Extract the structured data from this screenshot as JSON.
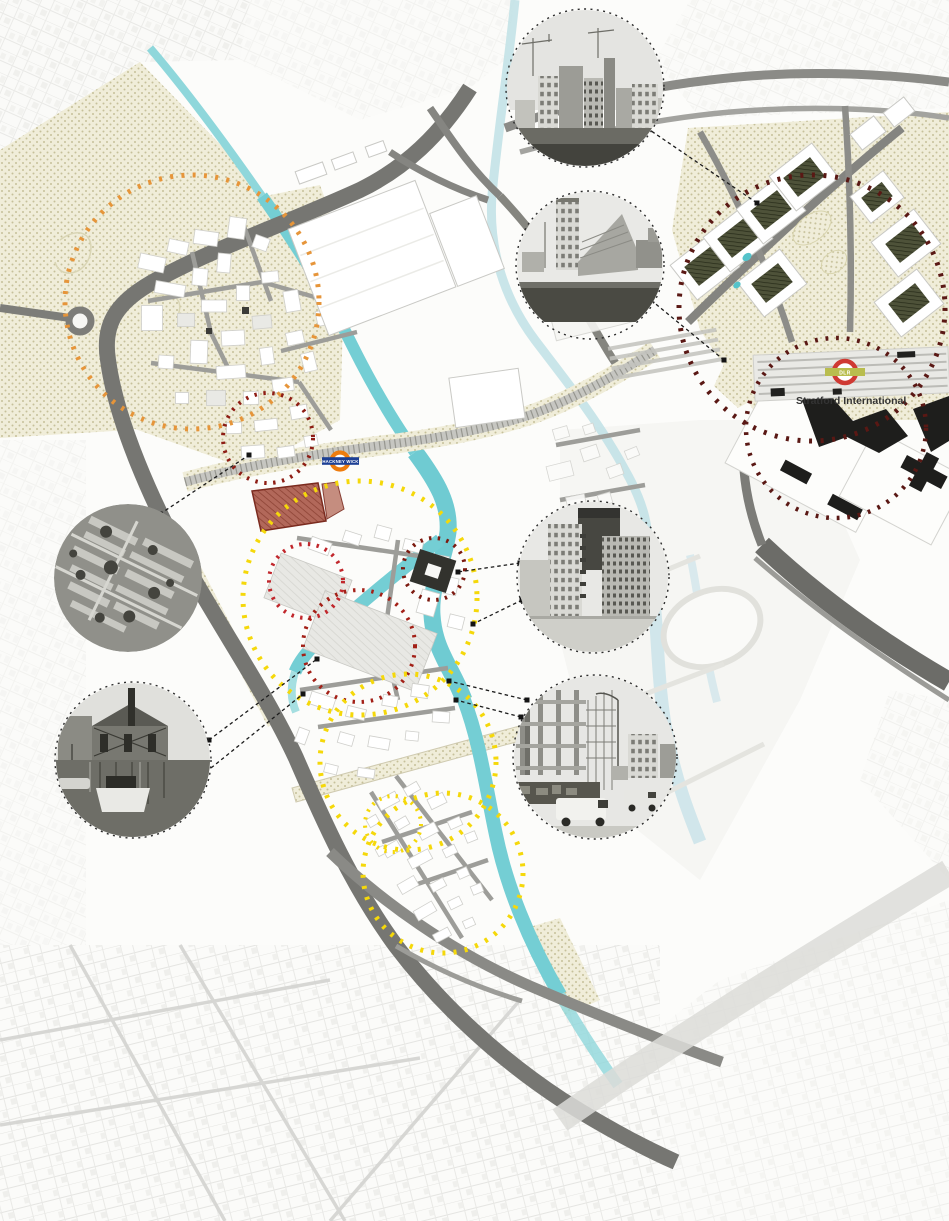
{
  "map": {
    "description": "Stylised urban analysis map of Hackney Wick, Fish Island and Stratford with black-and-white photo insets and dotted study-area circles",
    "labels": {
      "hackney_wick_station": "HACKNEY WICK",
      "dlr_badge": "DLR",
      "stratford_international": "Stratford International"
    },
    "colors": {
      "water": "#74ced4",
      "water_faded": "#c9e4ea",
      "road": "#767672",
      "building": "#ffffff",
      "landscape_dots": "#c6c09a",
      "site_parcel": "#b2685a",
      "circle_orange": "#e6953a",
      "circle_dark_red": "#5a1814",
      "circle_red": "#c1272c",
      "circle_red_deep": "#8e1d14",
      "circle_crimson_dark": "#a32017",
      "circle_maroon": "#7c1a10",
      "circle_yellow": "#f5d80a",
      "connector_line": "#1c1c1c",
      "roundel_orange": "#ee7c0e",
      "roundel_bar_blue": "#1c3f94",
      "dlr_ring": "#cf3a33",
      "dlr_bar": "#b9bd4e"
    },
    "photo_insets": [
      {
        "name": "stratford-towers-skyline-photo"
      },
      {
        "name": "stratford-halo-skyline-photo"
      },
      {
        "name": "aerial-terraced-housing-photo"
      },
      {
        "name": "canal-warehouse-boats-photo"
      },
      {
        "name": "new-apartment-block-photo"
      },
      {
        "name": "construction-site-photo"
      }
    ],
    "study_circles": [
      {
        "name": "hackney-wick-centre-area",
        "color_key": "circle_orange"
      },
      {
        "name": "east-village-area",
        "color_key": "circle_dark_red"
      },
      {
        "name": "stratford-city-area",
        "color_key": "circle_dark_red"
      },
      {
        "name": "station-north-site",
        "color_key": "circle_red_deep"
      },
      {
        "name": "central-wick-site",
        "color_key": "circle_red"
      },
      {
        "name": "riverside-site",
        "color_key": "circle_maroon"
      },
      {
        "name": "old-ford-site",
        "color_key": "circle_crimson_dark"
      },
      {
        "name": "hackney-wick-yellow-area",
        "color_key": "circle_yellow"
      },
      {
        "name": "fish-island-yellow-area",
        "color_key": "circle_yellow"
      },
      {
        "name": "south-fish-island-yellow-area",
        "color_key": "circle_yellow"
      },
      {
        "name": "small-yellow-site",
        "color_key": "circle_yellow"
      }
    ]
  }
}
